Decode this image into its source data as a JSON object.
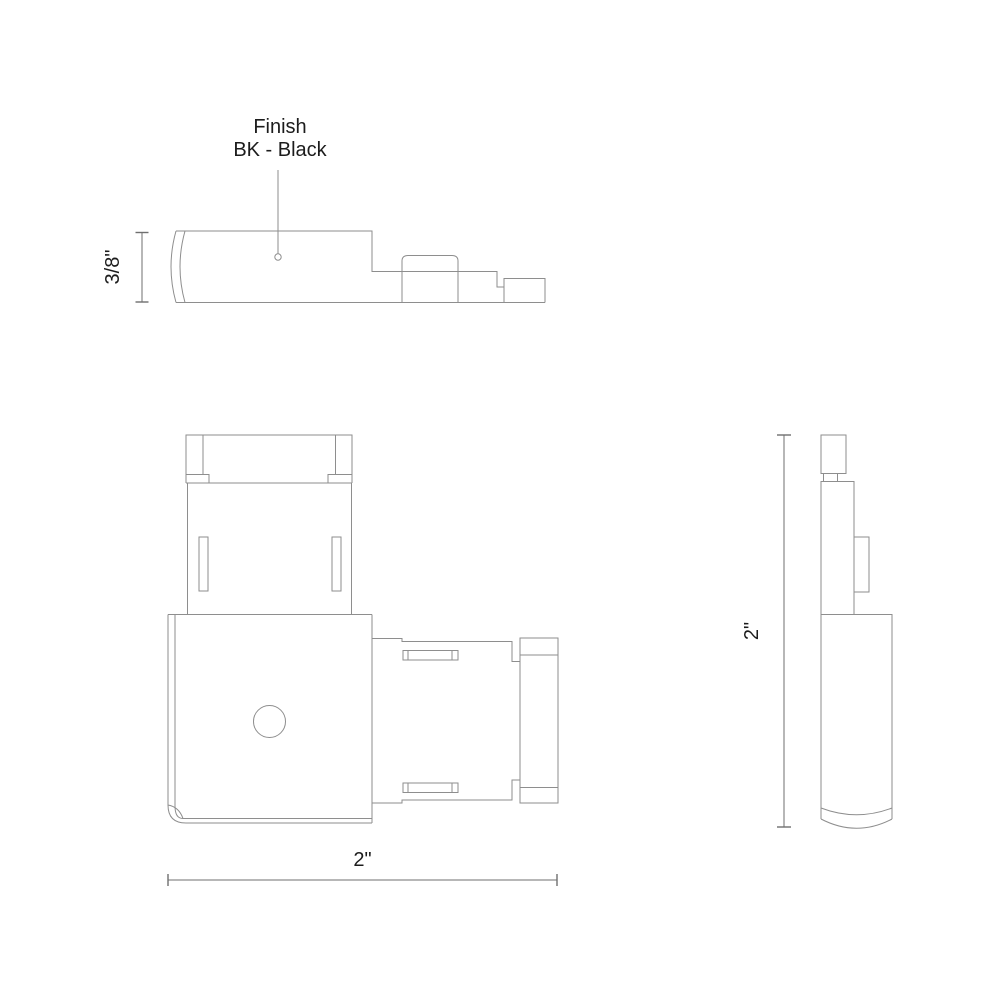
{
  "drawing": {
    "finish_callout": {
      "line1": "Finish",
      "line2": "BK - Black"
    },
    "dimensions": {
      "thickness": "3/8\"",
      "width": "2\"",
      "height": "2\""
    }
  },
  "colors": {
    "background": "#ffffff",
    "outline": "#8e8e8e",
    "dimension": "#6f6f6f",
    "text": "#1c1c1c"
  }
}
